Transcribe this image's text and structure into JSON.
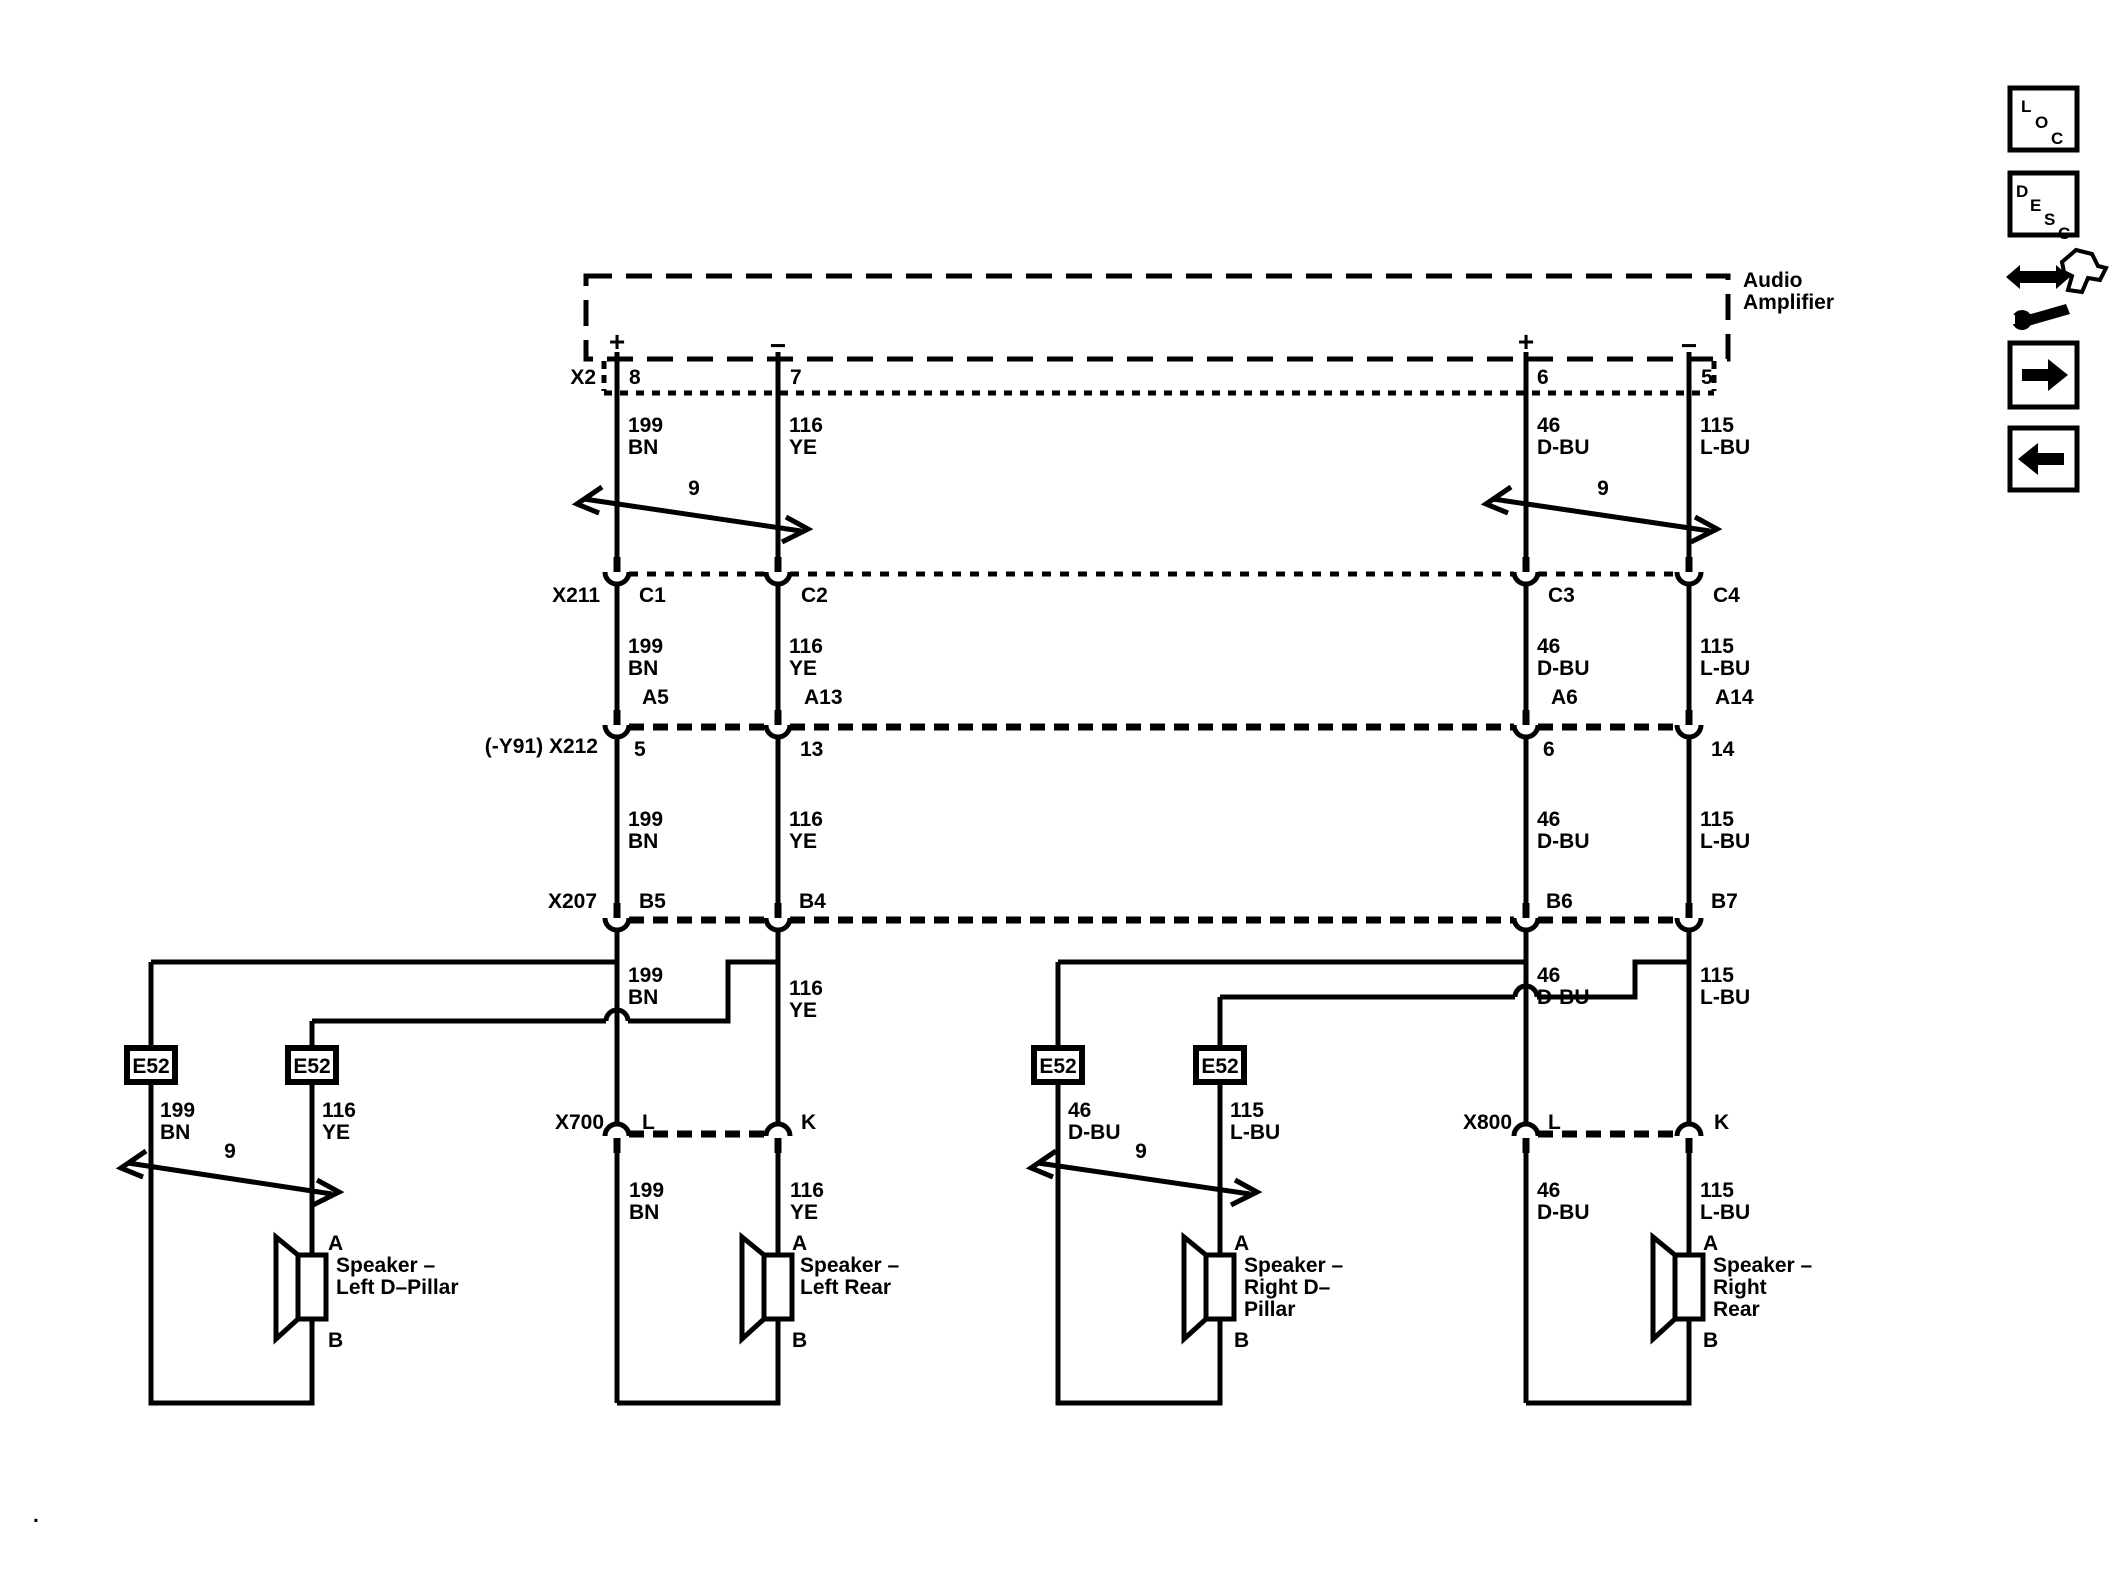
{
  "page": {
    "bg": "#ffffff",
    "ink": "#000000",
    "footer_dot": "."
  },
  "icons": {
    "loc": "LOC",
    "desc": "DESC"
  },
  "amplifier": {
    "line1": "Audio",
    "line2": "Amplifier",
    "plus": "+",
    "minus": "−"
  },
  "wires": {
    "w199": {
      "id": "199",
      "color": "BN"
    },
    "w116": {
      "id": "116",
      "color": "YE"
    },
    "w46": {
      "id": "46",
      "color": "D-BU"
    },
    "w115": {
      "id": "115",
      "color": "L-BU"
    }
  },
  "twist_label": "9",
  "grommet_label": "E52",
  "connectors": {
    "x2": {
      "label": "X2",
      "pins": [
        "8",
        "7",
        "6",
        "5"
      ]
    },
    "x211": {
      "label": "X211",
      "pins": [
        "C1",
        "C2",
        "C3",
        "C4"
      ]
    },
    "x212": {
      "label": "(-Y91) X212",
      "pins_top": [
        "A5",
        "A13",
        "A6",
        "A14"
      ],
      "pins_bottom": [
        "5",
        "13",
        "6",
        "14"
      ]
    },
    "x207": {
      "label": "X207",
      "pins": [
        "B5",
        "B4",
        "B6",
        "B7"
      ]
    },
    "x700": {
      "label": "X700",
      "pins": [
        "L",
        "K"
      ]
    },
    "x800": {
      "label": "X800",
      "pins": [
        "L",
        "K"
      ]
    }
  },
  "speakers": {
    "left_d_pillar": {
      "lines": [
        "Speaker –",
        "Left D–Pillar"
      ],
      "a": "A",
      "b": "B"
    },
    "left_rear": {
      "lines": [
        "Speaker –",
        "Left Rear"
      ],
      "a": "A",
      "b": "B"
    },
    "right_d_pillar": {
      "lines": [
        "Speaker –",
        "Right D–",
        "Pillar"
      ],
      "a": "A",
      "b": "B"
    },
    "right_rear": {
      "lines": [
        "Speaker –",
        "Right",
        "Rear"
      ],
      "a": "A",
      "b": "B"
    }
  }
}
